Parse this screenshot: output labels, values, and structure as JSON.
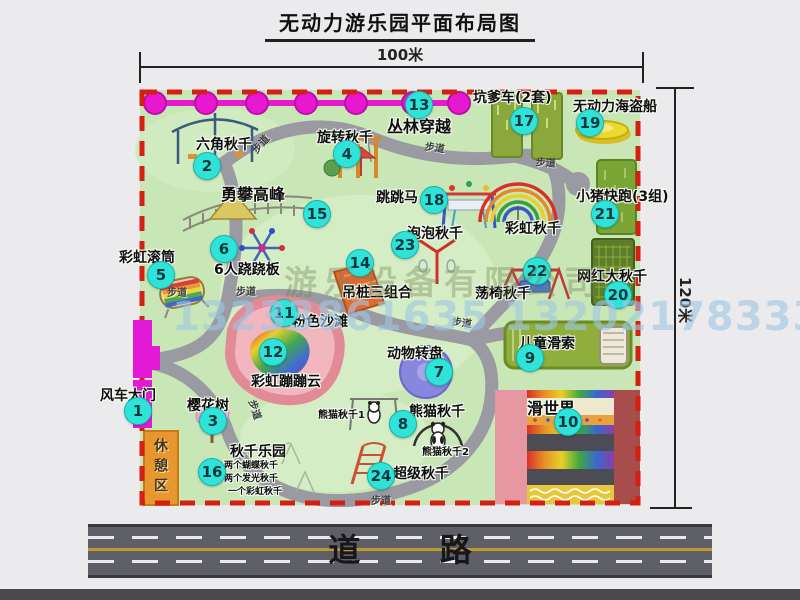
{
  "title": "无动力游乐园平面布局图",
  "dimension_top": "100米",
  "dimension_right": "120米",
  "road_label": "道 路",
  "path_label": "步道",
  "rest_area": "休憩区",
  "rainbow_swing": "彩虹秋千",
  "panda_sub1": "熊猫秋千1",
  "panda_sub2": "熊猫秋千2",
  "swing_park_notes": [
    "两个蝴蝶秋千",
    "两个发光秋千",
    "一个彩虹秋千"
  ],
  "watermark_company": "游乐设备有限公司",
  "watermark_phone": "13233861635 13202178333",
  "colors": {
    "map_green": "#c9e6b6",
    "border_red": "#d42010",
    "badge_cyan": "#2fe3d9",
    "chain_magenta": "#e818d0",
    "road_gray": "#5e5e66",
    "rest_area_orange": "#e8962e"
  },
  "attractions": [
    {
      "num": "1",
      "name": "风车大门"
    },
    {
      "num": "2",
      "name": "六角秋千"
    },
    {
      "num": "3",
      "name": "樱花树"
    },
    {
      "num": "4",
      "name": "旋转秋千"
    },
    {
      "num": "5",
      "name": "彩虹滚筒"
    },
    {
      "num": "6",
      "name": "6人跷跷板"
    },
    {
      "num": "7",
      "name": "动物转盘"
    },
    {
      "num": "8",
      "name": "熊猫秋千"
    },
    {
      "num": "9",
      "name": "儿童滑索"
    },
    {
      "num": "10",
      "name": "滑世界"
    },
    {
      "num": "11",
      "name": "粉色沙滩"
    },
    {
      "num": "12",
      "name": "彩虹蹦蹦云"
    },
    {
      "num": "13",
      "name": "丛林穿越"
    },
    {
      "num": "14",
      "name": "吊桩三组合"
    },
    {
      "num": "15",
      "name": "勇攀高峰"
    },
    {
      "num": "16",
      "name": "秋千乐园"
    },
    {
      "num": "17",
      "name": "坑爹车(2套)"
    },
    {
      "num": "18",
      "name": "跳跳马"
    },
    {
      "num": "19",
      "name": "无动力海盗船"
    },
    {
      "num": "20",
      "name": "网红大秋千"
    },
    {
      "num": "21",
      "name": "小猪快跑(3组)"
    },
    {
      "num": "22",
      "name": "荡椅秋千"
    },
    {
      "num": "23",
      "name": "泡泡秋千"
    },
    {
      "num": "24",
      "name": "超级秋千"
    }
  ]
}
